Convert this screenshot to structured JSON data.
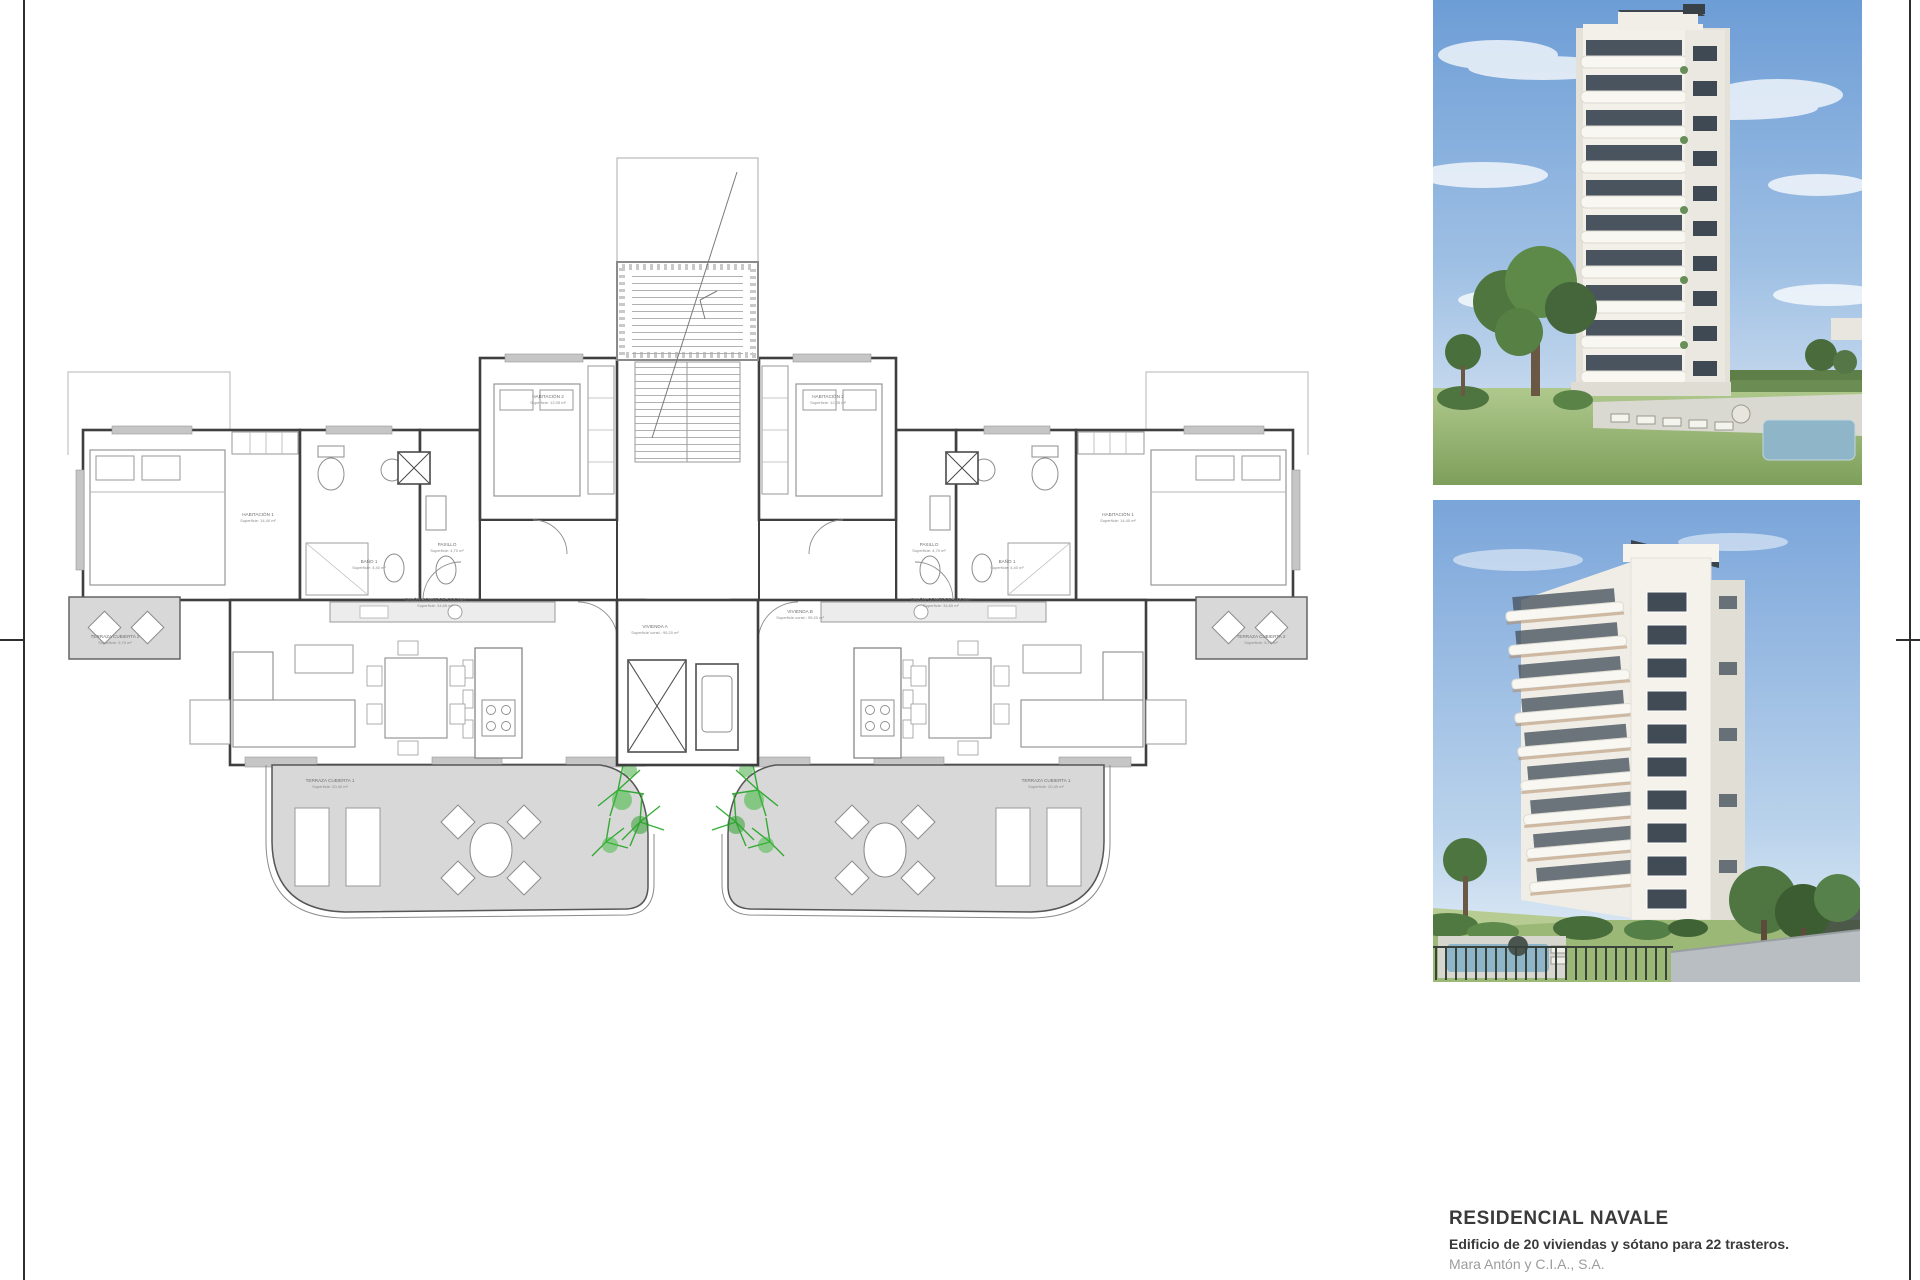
{
  "sheet": {
    "border_color": "#2e2e2e",
    "background": "#ffffff"
  },
  "title_block": {
    "project_name": "RESIDENCIAL NAVALE",
    "description": "Edificio de 20 viviendas y sótano para 22 trasteros.",
    "developer": "Mara Antón y C.I.A., S.A."
  },
  "floor_plan": {
    "rooms": {
      "habitacion1": {
        "name": "HABITACIÓN 1",
        "area": "Superficie: 14,40 m²"
      },
      "habitacion2": {
        "name": "HABITACIÓN 2",
        "area": "Superficie: 12,05 m²"
      },
      "bano1": {
        "name": "BAÑO 1",
        "area": "Superficie: 4,40 m²"
      },
      "pasillo": {
        "name": "PASILLO",
        "area": "Superficie: 4,70 m²"
      },
      "salon": {
        "name": "SALÓN-COMEDOR-COCINA",
        "area": "Superficie: 34,65 m²"
      },
      "vivienda_a": {
        "name": "VIVIENDA A",
        "area": "Superficie const.: 95,20 m²"
      },
      "vivienda_b": {
        "name": "VIVIENDA B",
        "area": "Superficie const.: 95,20 m²"
      },
      "terraza_cubierta1": {
        "name": "TERRAZA CUBIERTA 1",
        "area": "Superficie: 20,40 m²"
      },
      "terraza_cubierta2": {
        "name": "TERRAZA CUBIERTA 2",
        "area": "Superficie: 5,70 m²"
      }
    },
    "colors": {
      "wall": "#3f3f3f",
      "light_line": "#b5b5b5",
      "terrace_fill": "#d8d8d8",
      "plant_green": "#22a522"
    }
  },
  "renders": {
    "top": {
      "alt": "White residential tower with curved balconies, garden, sunbeds and pool"
    },
    "bottom": {
      "alt": "Corner view of the white tower with balconies, pool, fence and street"
    }
  }
}
